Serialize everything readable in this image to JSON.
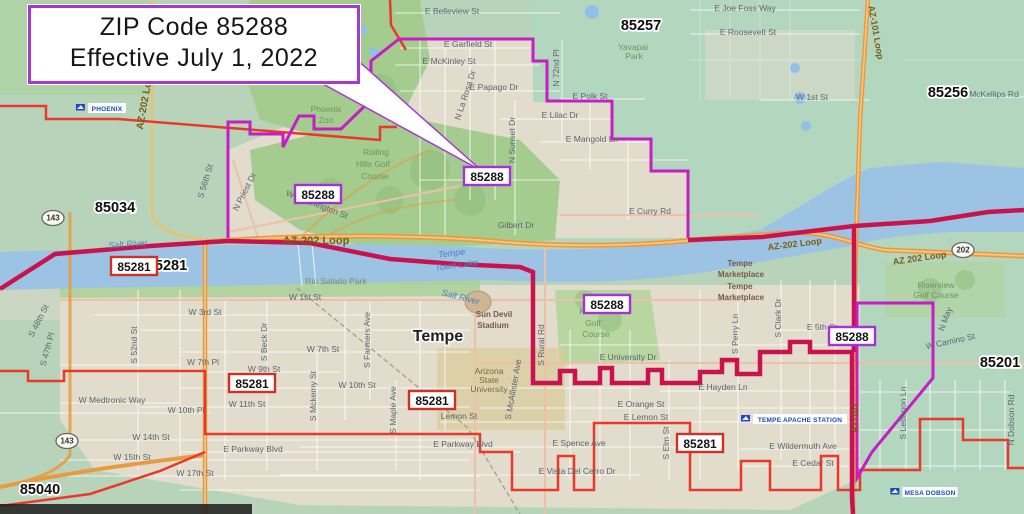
{
  "callout": {
    "line1": "ZIP Code 85288",
    "line2": "Effective July 1, 2022"
  },
  "colors": {
    "base_green": "#b7d4ba",
    "urban_beige": "#e1dccb",
    "parkland": "#a3cc8e",
    "water": "#9cc3e3",
    "highway_orange": "#ea9a3e",
    "boundary_new_magenta": "#c41ec4",
    "boundary_red": "#e8392b",
    "boundary_crimson": "#c9134f",
    "zip_badge_purple_border": "#a133d8",
    "zip_badge_red_border": "#cf3126"
  },
  "zip_badges": {
    "purple": [
      {
        "t": "85288",
        "x": 318,
        "y": 198
      },
      {
        "t": "85288",
        "x": 487,
        "y": 180
      },
      {
        "t": "85288",
        "x": 607,
        "y": 308
      },
      {
        "t": "85288",
        "x": 852,
        "y": 340
      }
    ],
    "red": [
      {
        "t": "85281",
        "x": 134,
        "y": 270
      },
      {
        "t": "85281",
        "x": 252,
        "y": 387
      },
      {
        "t": "85281",
        "x": 432,
        "y": 404
      },
      {
        "t": "85281",
        "x": 700,
        "y": 447
      }
    ]
  },
  "zip_plain": [
    {
      "t": "85034",
      "x": 115,
      "y": 212
    },
    {
      "t": "85281",
      "x": 167,
      "y": 270
    },
    {
      "t": "85257",
      "x": 641,
      "y": 30
    },
    {
      "t": "85256",
      "x": 948,
      "y": 97
    },
    {
      "t": "85201",
      "x": 1000,
      "y": 367
    },
    {
      "t": "85040",
      "x": 40,
      "y": 494
    }
  ],
  "streets": [
    {
      "t": "E Belleview St",
      "x": 452,
      "y": 14
    },
    {
      "t": "E Joe Foss Way",
      "x": 745,
      "y": 11
    },
    {
      "t": "E Roosevelt St",
      "x": 748,
      "y": 35
    },
    {
      "t": "E Garfield St",
      "x": 468,
      "y": 47
    },
    {
      "t": "E McKinley St",
      "x": 449,
      "y": 64
    },
    {
      "t": "E Papago Dr",
      "x": 494,
      "y": 90
    },
    {
      "t": "E Polk St",
      "x": 590,
      "y": 99
    },
    {
      "t": "E Lilac Dr",
      "x": 560,
      "y": 118
    },
    {
      "t": "E Mangold Ln",
      "x": 592,
      "y": 142
    },
    {
      "t": "N 72nd Pl",
      "x": 559,
      "y": 68,
      "r": -90
    },
    {
      "t": "N Sunset Dr",
      "x": 515,
      "y": 140,
      "r": -90
    },
    {
      "t": "N La Rosa Dr",
      "x": 468,
      "y": 96,
      "r": -72
    },
    {
      "t": "W 1st St",
      "x": 812,
      "y": 100
    },
    {
      "t": "E McKellips Rd",
      "x": 990,
      "y": 97
    },
    {
      "t": "E Curry Rd",
      "x": 650,
      "y": 214
    },
    {
      "t": "Gilbert Dr",
      "x": 516,
      "y": 228
    },
    {
      "t": "W Washington St",
      "x": 316,
      "y": 207,
      "r": 21
    },
    {
      "t": "N Priest Dr",
      "x": 247,
      "y": 193,
      "r": -63
    },
    {
      "t": "S 56th St",
      "x": 208,
      "y": 182,
      "r": -73
    },
    {
      "t": "E University Dr",
      "x": 628,
      "y": 360
    },
    {
      "t": "E Orange St",
      "x": 641,
      "y": 407
    },
    {
      "t": "E Lemon St",
      "x": 646,
      "y": 420
    },
    {
      "t": "Lemon St",
      "x": 459,
      "y": 419
    },
    {
      "t": "E Spence Ave",
      "x": 579,
      "y": 446
    },
    {
      "t": "E Vista Del Cerro Dr",
      "x": 577,
      "y": 474
    },
    {
      "t": "E Parkway Blvd",
      "x": 253,
      "y": 452
    },
    {
      "t": "E Parkway Blvd",
      "x": 463,
      "y": 447
    },
    {
      "t": "E Wildermuth Ave",
      "x": 803,
      "y": 449
    },
    {
      "t": "E Cedar St",
      "x": 813,
      "y": 466
    },
    {
      "t": "E Hayden Ln",
      "x": 723,
      "y": 390
    },
    {
      "t": "E 5th St",
      "x": 822,
      "y": 330
    },
    {
      "t": "W 1st St",
      "x": 305,
      "y": 300
    },
    {
      "t": "W 3rd St",
      "x": 205,
      "y": 315
    },
    {
      "t": "W 7th St",
      "x": 323,
      "y": 352
    },
    {
      "t": "W 7th Pl",
      "x": 203,
      "y": 365
    },
    {
      "t": "W 9th St",
      "x": 264,
      "y": 372
    },
    {
      "t": "W 10th St",
      "x": 357,
      "y": 388
    },
    {
      "t": "W 11th St",
      "x": 247,
      "y": 407
    },
    {
      "t": "W 10th Pl",
      "x": 186,
      "y": 413
    },
    {
      "t": "W Medtronic Way",
      "x": 112,
      "y": 403
    },
    {
      "t": "W 14th St",
      "x": 151,
      "y": 440
    },
    {
      "t": "W 15th St",
      "x": 132,
      "y": 460
    },
    {
      "t": "W 17th St",
      "x": 195,
      "y": 476
    },
    {
      "t": "S 52nd St",
      "x": 137,
      "y": 345,
      "r": -90
    },
    {
      "t": "S Beck Dr",
      "x": 267,
      "y": 342,
      "r": -90
    },
    {
      "t": "S Farmers Ave",
      "x": 370,
      "y": 340,
      "r": -90
    },
    {
      "t": "S Mckemy St",
      "x": 316,
      "y": 396,
      "r": -90
    },
    {
      "t": "S Maple Ave",
      "x": 396,
      "y": 410,
      "r": -90
    },
    {
      "t": "S McAllister Ave",
      "x": 516,
      "y": 390,
      "r": -80
    },
    {
      "t": "S Rural Rd",
      "x": 544,
      "y": 345,
      "r": -90
    },
    {
      "t": "S Elm St",
      "x": 669,
      "y": 443,
      "r": -90
    },
    {
      "t": "S Perry Ln",
      "x": 738,
      "y": 334,
      "r": -90
    },
    {
      "t": "S Clark Dr",
      "x": 781,
      "y": 318,
      "r": -90
    },
    {
      "t": "S Lebanon Ln",
      "x": 906,
      "y": 413,
      "r": -90
    },
    {
      "t": "N Dobson Rd",
      "x": 1014,
      "y": 420,
      "r": -90
    },
    {
      "t": "N May",
      "x": 948,
      "y": 320,
      "r": -70
    },
    {
      "t": "W Camino St",
      "x": 951,
      "y": 344,
      "r": -12
    },
    {
      "t": "S 48th St",
      "x": 41,
      "y": 322,
      "r": -63
    },
    {
      "t": "S 47th Pl",
      "x": 50,
      "y": 350,
      "r": -75
    }
  ],
  "highway_labels": [
    {
      "t": "AZ-202 Loop",
      "x": 148,
      "y": 100,
      "r": -80,
      "s": 10
    },
    {
      "t": "AZ-202 Loop",
      "x": 316,
      "y": 244,
      "s": 11
    },
    {
      "t": "AZ-202 Loop",
      "x": 795,
      "y": 247,
      "r": -7,
      "s": 9
    },
    {
      "t": "AZ 202 Loop",
      "x": 920,
      "y": 261,
      "r": -8,
      "s": 9
    },
    {
      "t": "AZ-101 Loop",
      "x": 873,
      "y": 33,
      "r": 80,
      "s": 9
    },
    {
      "t": "AZ-101",
      "x": 858,
      "y": 418,
      "r": -88,
      "s": 9
    }
  ],
  "water_labels": [
    {
      "t": "Salt River",
      "x": 128,
      "y": 247,
      "r": -4
    },
    {
      "t": "Salt River",
      "x": 460,
      "y": 300,
      "r": 14
    },
    {
      "t": "Tempe",
      "x": 452,
      "y": 256,
      "r": -7
    },
    {
      "t": "Town Lake",
      "x": 457,
      "y": 268,
      "r": -7
    }
  ],
  "park_labels": [
    {
      "t": "Phoenix",
      "x": 326,
      "y": 112
    },
    {
      "t": "Zoo",
      "x": 326,
      "y": 123
    },
    {
      "t": "Rolling",
      "x": 376,
      "y": 155
    },
    {
      "t": "Hills Golf",
      "x": 373,
      "y": 167
    },
    {
      "t": "Course",
      "x": 375,
      "y": 179
    },
    {
      "t": "Karsten",
      "x": 594,
      "y": 314
    },
    {
      "t": "Golf",
      "x": 593,
      "y": 326
    },
    {
      "t": "Course",
      "x": 596,
      "y": 337
    },
    {
      "t": "Riverview",
      "x": 936,
      "y": 288
    },
    {
      "t": "Golf Course",
      "x": 936,
      "y": 298
    },
    {
      "t": "Rio Salado Park",
      "x": 336,
      "y": 284
    },
    {
      "t": "Yavapai",
      "x": 633,
      "y": 50
    },
    {
      "t": "Park",
      "x": 634,
      "y": 59
    }
  ],
  "place_labels": [
    {
      "t": "Tempe",
      "x": 740,
      "y": 266
    },
    {
      "t": "Marketplace",
      "x": 741,
      "y": 277
    },
    {
      "t": "Tempe",
      "x": 740,
      "y": 289
    },
    {
      "t": "Marketplace",
      "x": 741,
      "y": 300
    },
    {
      "t": "Sun Devil",
      "x": 494,
      "y": 317
    },
    {
      "t": "Stadium",
      "x": 493,
      "y": 328
    }
  ],
  "city_labels": [
    {
      "t": "Tempe",
      "x": 438,
      "y": 341
    }
  ],
  "edu_labels": [
    {
      "t": "Arizona",
      "x": 489,
      "y": 374
    },
    {
      "t": "State",
      "x": 489,
      "y": 383
    },
    {
      "t": "University",
      "x": 489,
      "y": 392
    }
  ],
  "postal_stations": [
    {
      "t": "PHOENIX",
      "x": 107,
      "y": 110
    },
    {
      "t": "TEMPE APACHE STATION",
      "x": 800,
      "y": 421
    },
    {
      "t": "MESA DOBSON",
      "x": 930,
      "y": 494
    }
  ],
  "shields": [
    {
      "t": "143",
      "x": 53,
      "y": 218
    },
    {
      "t": "143",
      "x": 67,
      "y": 441
    },
    {
      "t": "202",
      "x": 963,
      "y": 250
    }
  ]
}
